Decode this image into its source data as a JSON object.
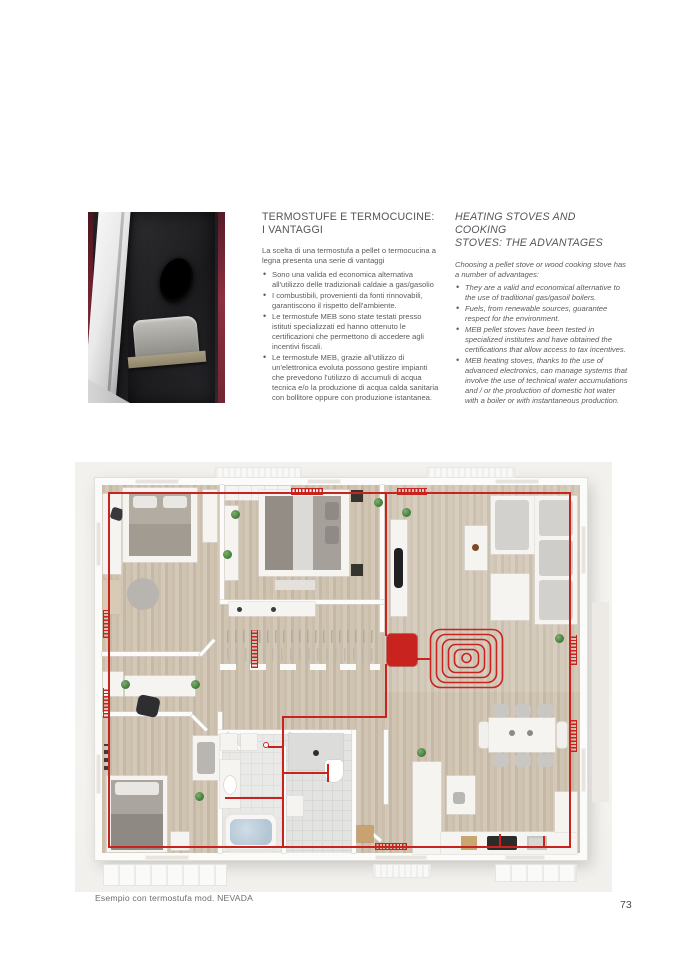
{
  "page": {
    "number": "73",
    "accent_red": "#c92320",
    "caption": "Esempio con termostufa mod. NEVADA"
  },
  "italian": {
    "title_line1": "TERMOSTUFE E TERMOCUCINE:",
    "title_line2": "I VANTAGGI",
    "intro": "La scelta di una termostufa a pellet o termocucina a legna presenta una serie di vantaggi",
    "bullets": [
      "Sono una valida ed economica alternativa all'utilizzo delle tradizionali caldaie a gas/gasolio",
      "I combustibili, provenienti da fonti rinnovabili, garantiscono il rispetto dell'ambiente.",
      "Le termostufe MEB sono state testati presso istituti specializzati ed hanno ottenuto le certificazioni che permettono di accedere agli incentivi fiscali.",
      "Le termostufe MEB, grazie all'utilizzo di un'elettronica evoluta possono gestire impianti che prevedono l'utilizzo di accumuli di acqua tecnica e/o la produzione di acqua calda sanitaria con bollitore oppure con produzione istantanea."
    ]
  },
  "english": {
    "title_line1": "HEATING STOVES AND COOKING",
    "title_line2": "STOVES: THE ADVANTAGES",
    "intro": "Choosing a pellet stove or wood cooking stove has a number of advantages:",
    "bullets": [
      "They are a valid and economical alternative to the use of traditional gas/gasoil boilers.",
      "Fuels, from renewable sources, guarantee respect for the environment.",
      "MEB pellet stoves have been tested in specialized institutes and have obtained the certifications that allow access to tax incentives.",
      "MEB heating stoves, thanks to the use of advanced electronics, can manage systems that involve the use of technical water accumulations and / or the production of domestic hot water with a boiler or with instantaneous production."
    ]
  }
}
